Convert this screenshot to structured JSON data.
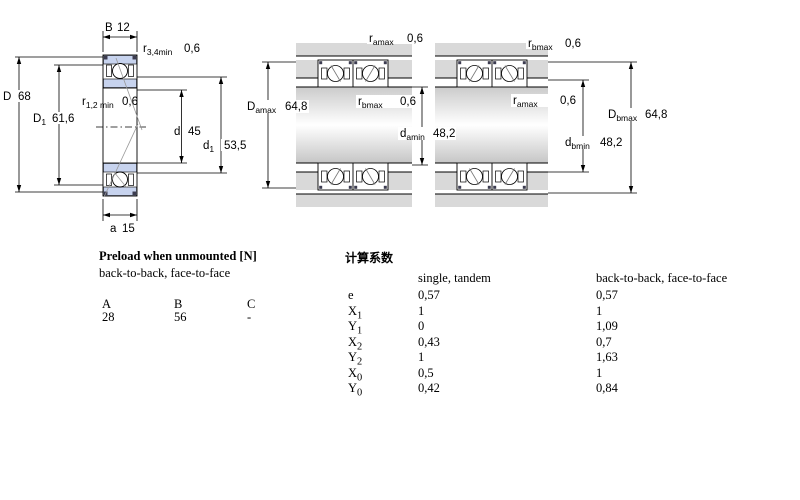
{
  "colors": {
    "bearing_ring_blue": "#c7d3ee",
    "housing_gray": "#d9d9d9",
    "seal_dark": "#3c3c50",
    "line_black": "#000000",
    "construction_gray": "#999999"
  },
  "diagrams": {
    "left": {
      "labels": {
        "B": {
          "main": "B",
          "value": "12"
        },
        "r34": {
          "main": "r",
          "sub": "3,4min",
          "value": "0,6"
        },
        "D": {
          "main": "D",
          "value": "68"
        },
        "D1": {
          "main": "D",
          "sub": "1",
          "value": "61,6"
        },
        "r12": {
          "main": "r",
          "sub": "1,2 min",
          "value": "0,6"
        },
        "d": {
          "main": "d",
          "value": "45"
        },
        "d1": {
          "main": "d",
          "sub": "1",
          "value": "53,5"
        },
        "a": {
          "main": "a",
          "value": "15"
        }
      }
    },
    "middle": {
      "labels": {
        "ramax": {
          "main": "r",
          "sub": "amax",
          "value": "0,6"
        },
        "Damax": {
          "main": "D",
          "sub": "amax",
          "value": "64,8"
        },
        "rbmax": {
          "main": "r",
          "sub": "bmax",
          "value": "0,6"
        },
        "damin": {
          "main": "d",
          "sub": "amin",
          "value": "48,2"
        }
      }
    },
    "right": {
      "labels": {
        "rbmax": {
          "main": "r",
          "sub": "bmax",
          "value": "0,6"
        },
        "ramax": {
          "main": "r",
          "sub": "amax",
          "value": "0,6"
        },
        "Dbmax": {
          "main": "D",
          "sub": "bmax",
          "value": "64,8"
        },
        "dbmin": {
          "main": "d",
          "sub": "bmin",
          "value": "48,2"
        }
      }
    }
  },
  "preload_table": {
    "title": "Preload when unmounted [N]",
    "subtitle": "back-to-back, face-to-face",
    "columns": [
      "A",
      "B",
      "C"
    ],
    "values": [
      "28",
      "56",
      "-"
    ]
  },
  "factors_table": {
    "title": "计算系数",
    "col1_header": "single, tandem",
    "col2_header": "back-to-back, face-to-face",
    "rows": [
      {
        "label": "e",
        "sub": "",
        "v1": "0,57",
        "v2": "0,57"
      },
      {
        "label": "X",
        "sub": "1",
        "v1": "1",
        "v2": "1"
      },
      {
        "label": "Y",
        "sub": "1",
        "v1": "0",
        "v2": "1,09"
      },
      {
        "label": "X",
        "sub": "2",
        "v1": "0,43",
        "v2": "0,7"
      },
      {
        "label": "Y",
        "sub": "2",
        "v1": "1",
        "v2": "1,63"
      },
      {
        "label": "X",
        "sub": "0",
        "v1": "0,5",
        "v2": "1"
      },
      {
        "label": "Y",
        "sub": "0",
        "v1": "0,42",
        "v2": "0,84"
      }
    ]
  }
}
